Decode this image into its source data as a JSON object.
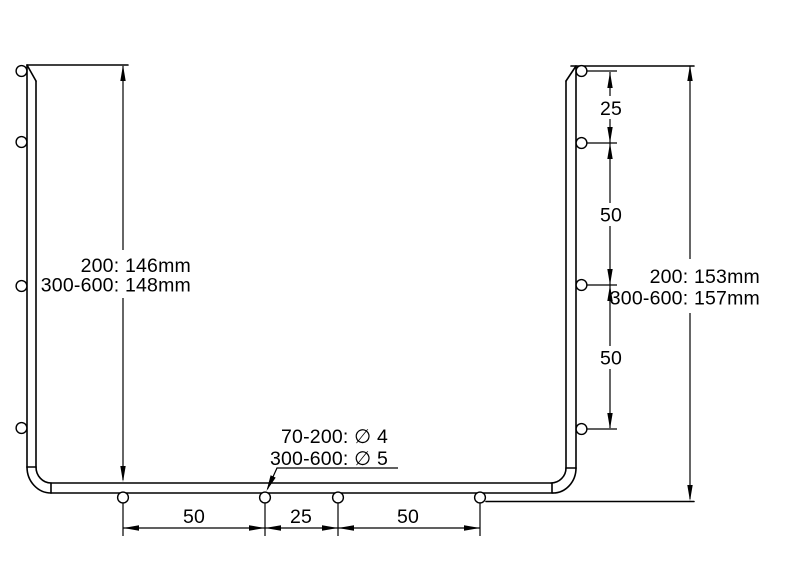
{
  "drawing": {
    "colors": {
      "background": "#ffffff",
      "line": "#000000"
    },
    "left_height_dimension": {
      "rows": [
        "200: 146mm",
        "300-600: 148mm"
      ]
    },
    "right_height_dimension": {
      "rows": [
        "200: 153mm",
        "300-600: 157mm"
      ]
    },
    "hole_diameter_callout": {
      "rows": [
        "70-200: ∅ 4",
        "300-600: ∅ 5"
      ]
    },
    "right_hole_spacing_dimension": {
      "labels": [
        "25",
        "50",
        "50"
      ]
    },
    "bottom_hole_spacing_dimension": {
      "labels": [
        "50",
        "25",
        "50"
      ]
    },
    "mounting_holes": {
      "left_count": 4,
      "right_count": 4,
      "bottom_count": 4
    }
  }
}
